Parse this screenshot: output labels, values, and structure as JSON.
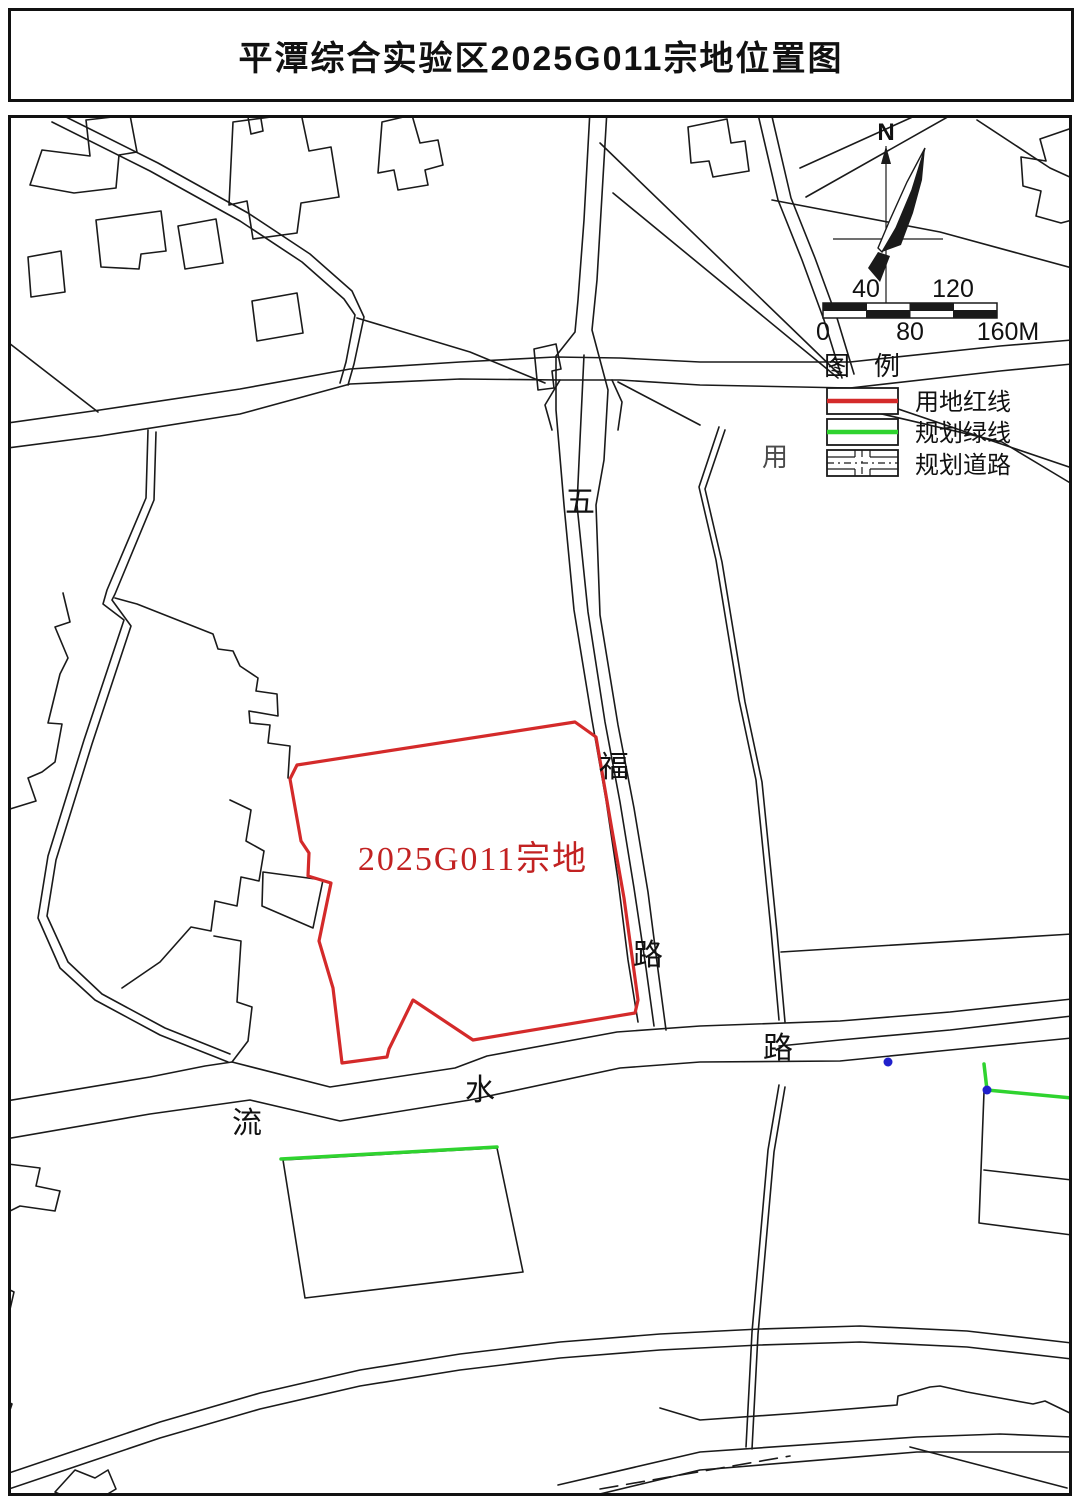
{
  "header": {
    "title": "平潭综合实验区2025G011宗地位置图"
  },
  "map": {
    "parcel_label": "2025G011宗地",
    "labels": {
      "wufu_road": [
        "五",
        "福",
        "路"
      ],
      "liushui_road": [
        "流",
        "水",
        "路"
      ],
      "partial_text": "用"
    }
  },
  "north_arrow": {
    "label": "N"
  },
  "scale_bar": {
    "labels_above": [
      "40",
      "120"
    ],
    "labels_below": [
      "0",
      "80",
      "160M"
    ]
  },
  "legend": {
    "title_chars": [
      "图",
      "例"
    ],
    "items": [
      {
        "label": "用地红线",
        "symbol": "red-line",
        "color": "#d42a2a"
      },
      {
        "label": "规划绿线",
        "symbol": "green-line",
        "color": "#2fd32f"
      },
      {
        "label": "规划道路",
        "symbol": "planned-road",
        "color": "#1a1a1a"
      }
    ]
  },
  "colors": {
    "parcel_red": "#d42a2a",
    "green_line": "#2fd32f",
    "blue_dot": "#2020cc",
    "line_black": "#1a1a1a"
  }
}
